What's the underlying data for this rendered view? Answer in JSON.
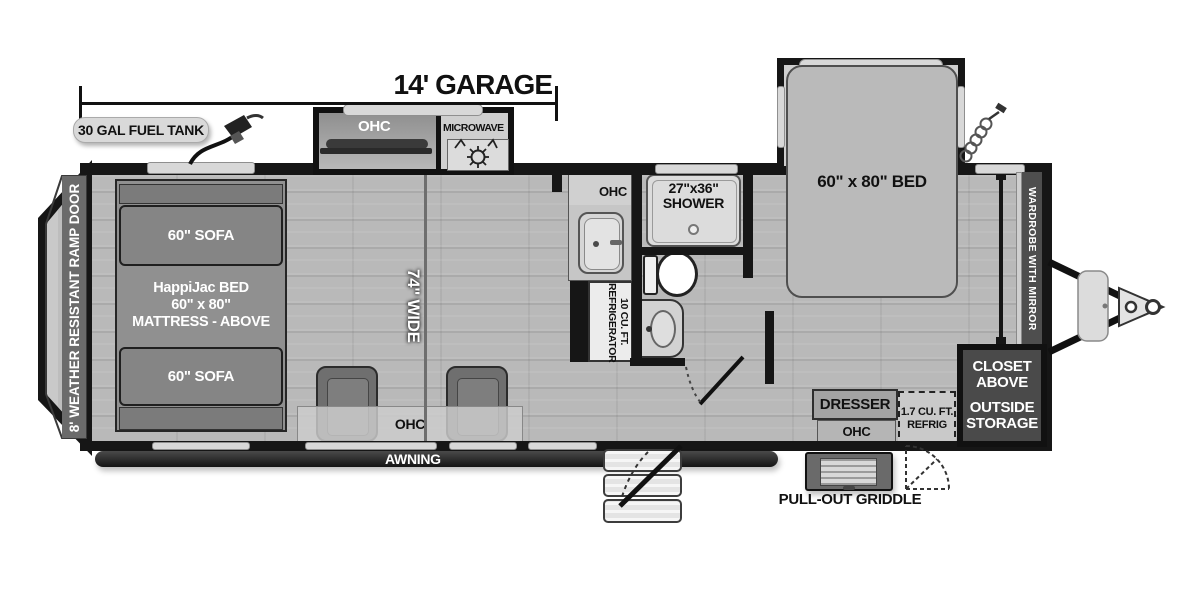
{
  "dimension": {
    "garage": "14' GARAGE"
  },
  "exterior": {
    "fuel_tank": "30 GAL FUEL TANK",
    "awning": "AWNING",
    "griddle": "PULL-OUT GRIDDLE",
    "ramp_door": "8' WEATHER RESISTANT RAMP DOOR"
  },
  "outdoor_kitchen": {
    "ohc": "OHC",
    "microwave": "MICROWAVE"
  },
  "garage": {
    "sofa_front": "60\" SOFA",
    "sofa_rear": "60\" SOFA",
    "happijac_1": "HappiJac BED",
    "happijac_2": "60\" x 80\"",
    "happijac_3": "MATTRESS - ABOVE",
    "width": "74\" WIDE",
    "ohc": "OHC"
  },
  "kitchen": {
    "ohc": "OHC",
    "fridge_1": "10 CU. FT.",
    "fridge_2": "REFRIGERATOR"
  },
  "bath": {
    "shower_1": "27\"x36\"",
    "shower_2": "SHOWER"
  },
  "bedroom": {
    "bed": "60\" x 80\" BED",
    "wardrobe": "WARDROBE WITH MIRROR",
    "dresser": "DRESSER",
    "ohc": "OHC",
    "mini_fridge_1": "1.7 CU. FT.",
    "mini_fridge_2": "REFRIG",
    "closet_1": "CLOSET",
    "closet_2": "ABOVE",
    "closet_3": "OUTSIDE",
    "closet_4": "STORAGE"
  },
  "colors": {
    "wall": "#161616",
    "floor": "#b9b9b9",
    "window": "#d8d8d8",
    "text_dark": "#111111"
  }
}
